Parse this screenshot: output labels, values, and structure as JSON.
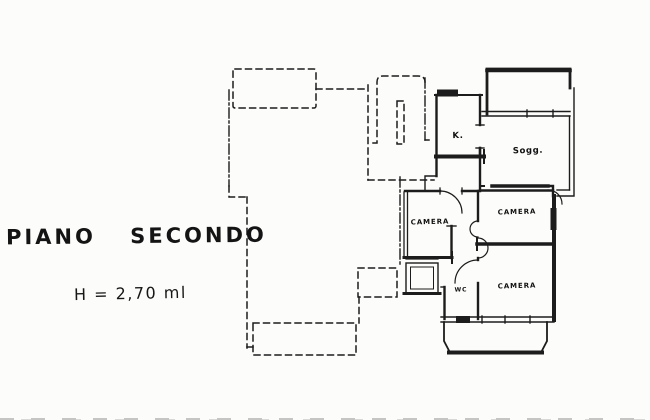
{
  "palette": {
    "paper": "#fcfcfa",
    "ink": "#1c1c1c"
  },
  "annotations": {
    "floor_title": "PIANO SECONDO",
    "ceiling_height": "H = 2,70 ml"
  },
  "rooms": [
    {
      "id": "kitchen",
      "label": "K."
    },
    {
      "id": "living-room",
      "label": "Sogg."
    },
    {
      "id": "bedroom-left",
      "label": "CAMERA"
    },
    {
      "id": "bedroom-top-right",
      "label": "CAMERA"
    },
    {
      "id": "bedroom-bottom-right",
      "label": "CAMERA"
    },
    {
      "id": "wc",
      "label": "WC"
    }
  ]
}
